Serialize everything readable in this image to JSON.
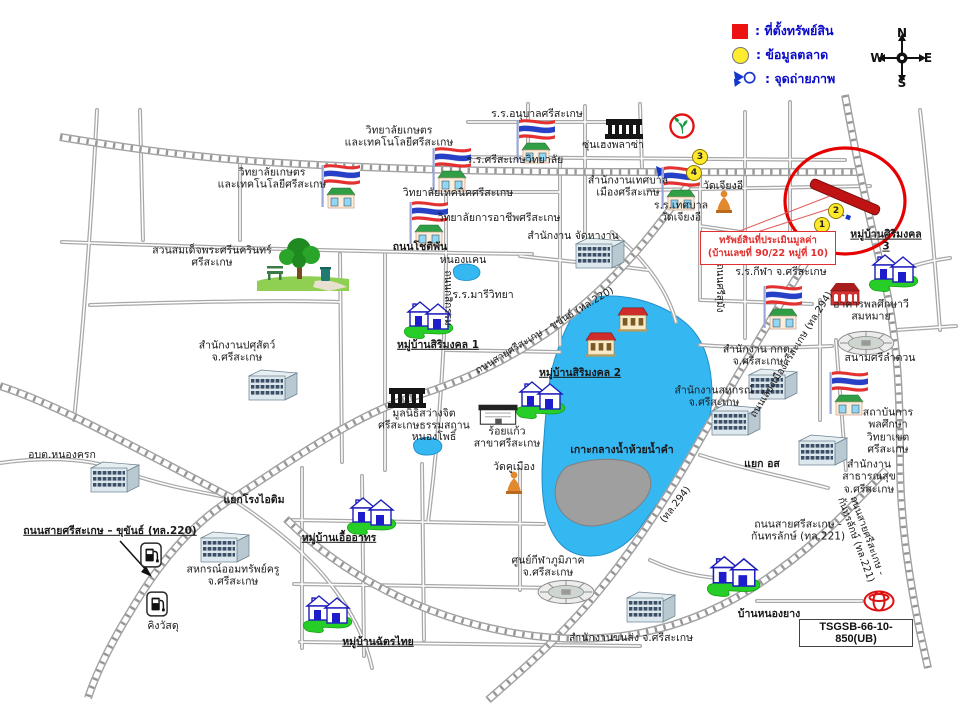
{
  "legend": {
    "items": [
      {
        "swatch": "red-square",
        "label": ": ที่ตั้งทรัพย์สิน"
      },
      {
        "swatch": "yellow-circle",
        "label": ": ข้อมูลตลาด"
      },
      {
        "swatch": "photo-arrow",
        "label": ": จุดถ่ายภาพ"
      }
    ]
  },
  "compass": {
    "n": "N",
    "e": "E",
    "s": "S",
    "w": "W"
  },
  "callout": {
    "line1": "ทรัพย์สินที่ประเมินมูลค่า",
    "line2": "(บ้านเลขที่ 90/22 หมู่ที่ 10)"
  },
  "ref_code": "TSGSB-66-10-850(UB)",
  "colors": {
    "property": "#c01414",
    "highlight_ellipse": "#e60000",
    "legend_text": "#0a0acc",
    "water": "#35b7f2",
    "island": "#9f9f9f",
    "road": "#a2a2a2"
  },
  "map": {
    "markers": [
      {
        "n": "1",
        "x": 822,
        "y": 225
      },
      {
        "n": "2",
        "x": 836,
        "y": 211
      },
      {
        "n": "3",
        "x": 700,
        "y": 157
      },
      {
        "n": "4",
        "x": 694,
        "y": 173
      }
    ],
    "pois": [
      {
        "name": "agri-college-building",
        "icon": "flagschool",
        "x": 341,
        "y": 186
      },
      {
        "name": "anuban-school-building",
        "icon": "flagschool",
        "x": 536,
        "y": 141
      },
      {
        "name": "technic-college-building",
        "icon": "flagschool",
        "x": 452,
        "y": 169
      },
      {
        "name": "vocational-college-building",
        "icon": "flagschool",
        "x": 429,
        "y": 223
      },
      {
        "name": "tessaban-school-building",
        "icon": "flagschool",
        "x": 681,
        "y": 188
      },
      {
        "name": "sport-school-building",
        "icon": "flagschool",
        "x": 783,
        "y": 307
      },
      {
        "name": "pe-institute-building",
        "icon": "flagschool",
        "x": 849,
        "y": 393
      },
      {
        "name": "sunheng-plaza-building",
        "icon": "darkbldg",
        "x": 624,
        "y": 129
      },
      {
        "name": "sawangjit-foundation-building",
        "icon": "darkbldg",
        "x": 407,
        "y": 398
      },
      {
        "name": "livestock-office-building",
        "icon": "office",
        "x": 272,
        "y": 385
      },
      {
        "name": "employment-office-building",
        "icon": "office",
        "x": 599,
        "y": 253
      },
      {
        "name": "cooperative-office-building-1",
        "icon": "office",
        "x": 772,
        "y": 384
      },
      {
        "name": "cooperative-office-building-2",
        "icon": "office",
        "x": 735,
        "y": 420
      },
      {
        "name": "public-health-office-building",
        "icon": "office",
        "x": 822,
        "y": 450
      },
      {
        "name": "nongkrok-sao-building",
        "icon": "office",
        "x": 114,
        "y": 477
      },
      {
        "name": "teacher-coop-building",
        "icon": "office",
        "x": 224,
        "y": 547
      },
      {
        "name": "transport-office-building",
        "icon": "office",
        "x": 650,
        "y": 607
      },
      {
        "name": "kbank-branch",
        "icon": "kbank",
        "x": 682,
        "y": 126
      },
      {
        "name": "chiang-ee-temple-buddha",
        "icon": "buddha",
        "x": 724,
        "y": 202
      },
      {
        "name": "khu-mueang-temple-buddha",
        "icon": "buddha",
        "x": 514,
        "y": 483
      },
      {
        "name": "park-trees",
        "icon": "trees",
        "x": 303,
        "y": 264
      },
      {
        "name": "nong-khaen-pond",
        "icon": "pond",
        "x": 466,
        "y": 272,
        "w": 38,
        "h": 22
      },
      {
        "name": "nong-pho-pond",
        "icon": "pond",
        "x": 427,
        "y": 446,
        "w": 36,
        "h": 28
      },
      {
        "name": "sirimongkol1-houses",
        "icon": "houses",
        "x": 428,
        "y": 317
      },
      {
        "name": "sirimongkol2-houses",
        "icon": "houses",
        "x": 540,
        "y": 397
      },
      {
        "name": "sirimongkol3-houses",
        "icon": "houses",
        "x": 893,
        "y": 270
      },
      {
        "name": "uea-athon-houses",
        "icon": "houses",
        "x": 371,
        "y": 513
      },
      {
        "name": "chatthai-houses",
        "icon": "houses",
        "x": 327,
        "y": 611
      },
      {
        "name": "nongyang-houses",
        "icon": "houses",
        "x": 733,
        "y": 573,
        "w": 62,
        "h": 50
      },
      {
        "name": "mansion-1",
        "icon": "mansion",
        "x": 633,
        "y": 319
      },
      {
        "name": "mansion-2",
        "icon": "mansion",
        "x": 601,
        "y": 344
      },
      {
        "name": "pe-building",
        "icon": "redbldg",
        "x": 845,
        "y": 294
      },
      {
        "name": "srilamduan-stadium",
        "icon": "stadium",
        "x": 866,
        "y": 343
      },
      {
        "name": "regional-sports-stadium",
        "icon": "stadium",
        "x": 566,
        "y": 592
      },
      {
        "name": "gas-station-1",
        "icon": "gas",
        "x": 151,
        "y": 555
      },
      {
        "name": "gas-station-2",
        "icon": "gas",
        "x": 157,
        "y": 604
      },
      {
        "name": "roikaew-shop-building",
        "icon": "shop",
        "x": 498,
        "y": 414
      },
      {
        "name": "toyota-dealer-logo",
        "icon": "toyota",
        "x": 879,
        "y": 601
      },
      {
        "name": "agri-college-label",
        "label": "วิทยาลัยเกษตร\nและเทคโนโลยีศรีสะเกษ",
        "x": 272,
        "y": 179
      },
      {
        "name": "agri-college-label-2",
        "label": "วิทยาลัยเกษตร\nและเทคโนโลยีศรีสะเกษ",
        "x": 399,
        "y": 137
      },
      {
        "name": "anuban-school-label",
        "label": "ร.ร.อนุบาลศรีสะเกษ",
        "x": 537,
        "y": 114
      },
      {
        "name": "sisaket-wittayalai-label",
        "label": "ร.ร.ศรีสะเกษวิทยาลัย",
        "x": 515,
        "y": 160
      },
      {
        "name": "technic-college-label",
        "label": "วิทยาลัยเทคนิคศรีสะเกษ",
        "x": 458,
        "y": 193
      },
      {
        "name": "vocational-college-label",
        "label": "วิทยาลัยการอาชีพศรีสะเกษ",
        "x": 499,
        "y": 218
      },
      {
        "name": "chotiphan-road-label",
        "label": "ถนนโชติพัน",
        "cls": "road",
        "x": 420,
        "y": 247
      },
      {
        "name": "nong-khaen-label",
        "label": "หนองแคน",
        "x": 463,
        "y": 260
      },
      {
        "name": "maree-wittaya-label",
        "label": "ร.ร.มารีวิทยา",
        "x": 483,
        "y": 295
      },
      {
        "name": "sirimongkol1-label",
        "label": "หมู่บ้านสิริมงคล 1",
        "cls": "village",
        "x": 438,
        "y": 345
      },
      {
        "name": "park-label",
        "label": "สวนสมเด็จพระศรีนครินทร์\nศรีสะเกษ",
        "x": 212,
        "y": 257
      },
      {
        "name": "livestock-office-label",
        "label": "สำนักงานปศุสัตว์\nจ.ศรีสะเกษ",
        "x": 237,
        "y": 352
      },
      {
        "name": "kasikam-road-label",
        "label": "ถนนกสิกรรม",
        "rot": 90,
        "x": 447,
        "y": 298,
        "fs": 10
      },
      {
        "name": "sunheng-plaza-label",
        "label": "ซุ่นเฮงพลาซ่า",
        "x": 613,
        "y": 145
      },
      {
        "name": "municipality-label",
        "label": "สำนักงานเทศบาล\nเมืองศรีสะเกษ",
        "x": 628,
        "y": 187
      },
      {
        "name": "employment-office-label",
        "label": "สำนักงาน จัดหางาน",
        "x": 573,
        "y": 236
      },
      {
        "name": "chiang-ee-temple-label",
        "label": "วัดเจียงอี",
        "x": 723,
        "y": 186
      },
      {
        "name": "tessaban-school-label",
        "label": "ร.ร.เทศบาล\nวัดเจียงอี",
        "x": 681,
        "y": 212
      },
      {
        "name": "sirimongkol3-label",
        "label": "หมู่บ้านศิริมงคล 3",
        "cls": "village",
        "x": 886,
        "y": 241
      },
      {
        "name": "sport-school-label",
        "label": "ร.ร.กีฬา จ.ศรีสะเกษ",
        "x": 781,
        "y": 272
      },
      {
        "name": "pe-building-label",
        "label": "อาคารพลศึกษาวีสมหมาย",
        "x": 871,
        "y": 311
      },
      {
        "name": "srilamduan-label",
        "label": "สนามศรีลำดวน",
        "x": 880,
        "y": 358
      },
      {
        "name": "ect-office-label",
        "label": "สำนักงาน กกต.\nจ.ศรีสะเกษ",
        "x": 758,
        "y": 356
      },
      {
        "name": "pe-institute-label",
        "label": "สถาบันการพลศึกษา\nวิทยาเขตศรีสะเกษ",
        "x": 888,
        "y": 431
      },
      {
        "name": "public-health-label",
        "label": "สำนักงานสาธารณสุข\nจ.ศรีสะเกษ",
        "x": 869,
        "y": 477
      },
      {
        "name": "cooperative-office-label",
        "label": "สำนักงานสหกรณ์\nจ.ศรีสะเกษ",
        "x": 714,
        "y": 397
      },
      {
        "name": "or-so-junction-label",
        "label": "แยก อส",
        "cls": "road",
        "x": 762,
        "y": 464
      },
      {
        "name": "island-label",
        "label": "เกาะกลางน้ำห้วยน้ำคำ",
        "cls": "road",
        "x": 622,
        "y": 450
      },
      {
        "name": "sawangjit-label",
        "label": "มูลนิธิสว่างจิต\nศรีสะเกษธรรมสถาน",
        "x": 424,
        "y": 420
      },
      {
        "name": "nong-pho-label",
        "label": "หนองโพธิ์",
        "x": 434,
        "y": 437
      },
      {
        "name": "roikaew-label",
        "label": "ร้อยแก้ว\nสาขาศรีสะเกษ",
        "x": 507,
        "y": 438
      },
      {
        "name": "khu-mueang-temple-label",
        "label": "วัดคูเมือง",
        "x": 514,
        "y": 467
      },
      {
        "name": "sirimongkol2-label",
        "label": "หมู่บ้านสิริมงคล 2",
        "cls": "village",
        "x": 580,
        "y": 373
      },
      {
        "name": "hwy220-diagonal-label",
        "label": "ถนนสายศรีสะเกษ - ขุขันธ์ (ทล.220)",
        "rot": -31,
        "x": 545,
        "y": 331,
        "fs": 10
      },
      {
        "name": "rongaitim-junction-label",
        "label": "แยกโรงไอติม",
        "cls": "road",
        "x": 254,
        "y": 500
      },
      {
        "name": "nongkrok-sao-label",
        "label": "อบต.หนองครก",
        "x": 62,
        "y": 455
      },
      {
        "name": "hwy220-label",
        "label": "ถนนสายศรีสะเกษ – ขุขันธ์ (ทล.220)",
        "cls": "roadu",
        "x": 110,
        "y": 531,
        "fs": 10.5
      },
      {
        "name": "king-watsadu-label",
        "label": "คิงวัสดุ",
        "x": 163,
        "y": 626
      },
      {
        "name": "teacher-coop-label",
        "label": "สหกรณ์ออมทรัพย์ครู\nจ.ศรีสะเกษ",
        "x": 233,
        "y": 576
      },
      {
        "name": "uea-athon-label",
        "label": "หมู่บ้านเอื้ออาทร",
        "cls": "village",
        "x": 339,
        "y": 538
      },
      {
        "name": "chatthai-label",
        "label": "หมู่บ้านฉัตรไทย",
        "cls": "village",
        "x": 378,
        "y": 642
      },
      {
        "name": "regional-sports-label",
        "label": "ศูนย์กีฬาภูมิภาค\nจ.ศรีสะเกษ",
        "x": 548,
        "y": 567
      },
      {
        "name": "transport-office-label",
        "label": "สำนักงานขนส่ง จ.ศรีสะเกษ",
        "x": 631,
        "y": 638
      },
      {
        "name": "nongyang-label",
        "label": "บ้านหนองยาง",
        "cls": "road",
        "x": 769,
        "y": 614
      },
      {
        "name": "hwy221-label",
        "label": "ถนนสายศรีสะเกษ -\nกันทรลักษ์ (ทล.221)",
        "x": 798,
        "y": 531
      },
      {
        "name": "hwy221-diagonal-label",
        "label": "ถนนสายศรีสะเกษ - กันทรลักษ์ (ทล.221)",
        "rot": 70,
        "x": 861,
        "y": 538,
        "fs": 10
      },
      {
        "name": "hwy294-diagonal-label",
        "label": "ถนนเลี่ยงเมืองศรีสะเกษ (ทล.294)",
        "rot": -58,
        "x": 792,
        "y": 355,
        "fs": 10
      },
      {
        "name": "hwy294-small-label",
        "label": "(ทล.294)",
        "rot": -52,
        "x": 676,
        "y": 505,
        "fs": 10
      },
      {
        "name": "srisumang-road-label",
        "label": "ถนนศรีสุมัง",
        "rot": 90,
        "x": 719,
        "y": 288,
        "fs": 10
      }
    ]
  }
}
